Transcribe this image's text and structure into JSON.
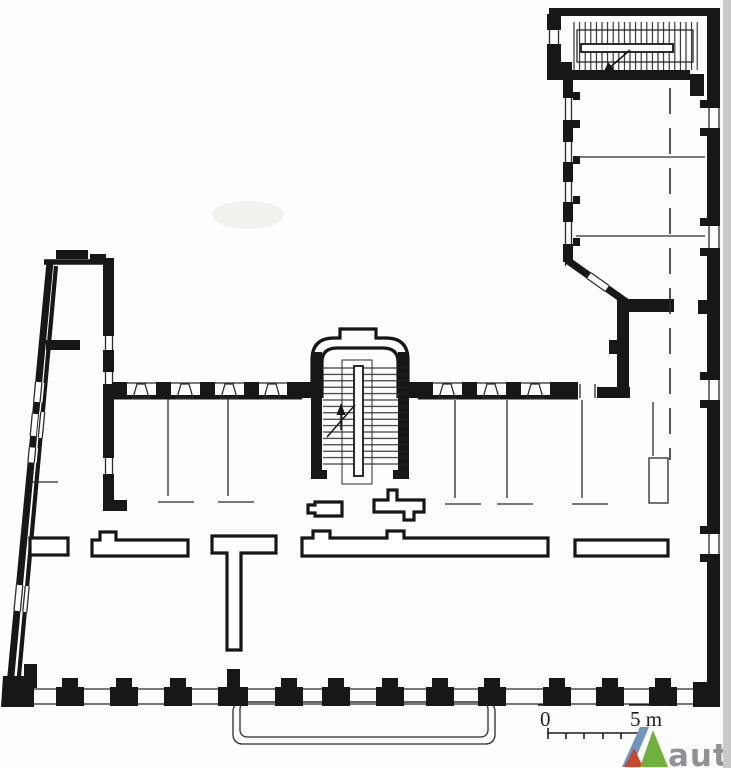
{
  "drawing": {
    "kind": "architectural-floor-plan",
    "scale_bar": {
      "start_label": "0",
      "end_label": "5 m"
    },
    "watermark": {
      "text": "autc",
      "text_color": "#8f9296",
      "logo": {
        "left_color": "#6f94c4",
        "right_color": "#6fb03e",
        "accent_color": "#c9472f"
      }
    },
    "colors": {
      "wall": "#171717",
      "paper": "#fdfdfd",
      "paper_edge": "#c9c9c9"
    }
  }
}
